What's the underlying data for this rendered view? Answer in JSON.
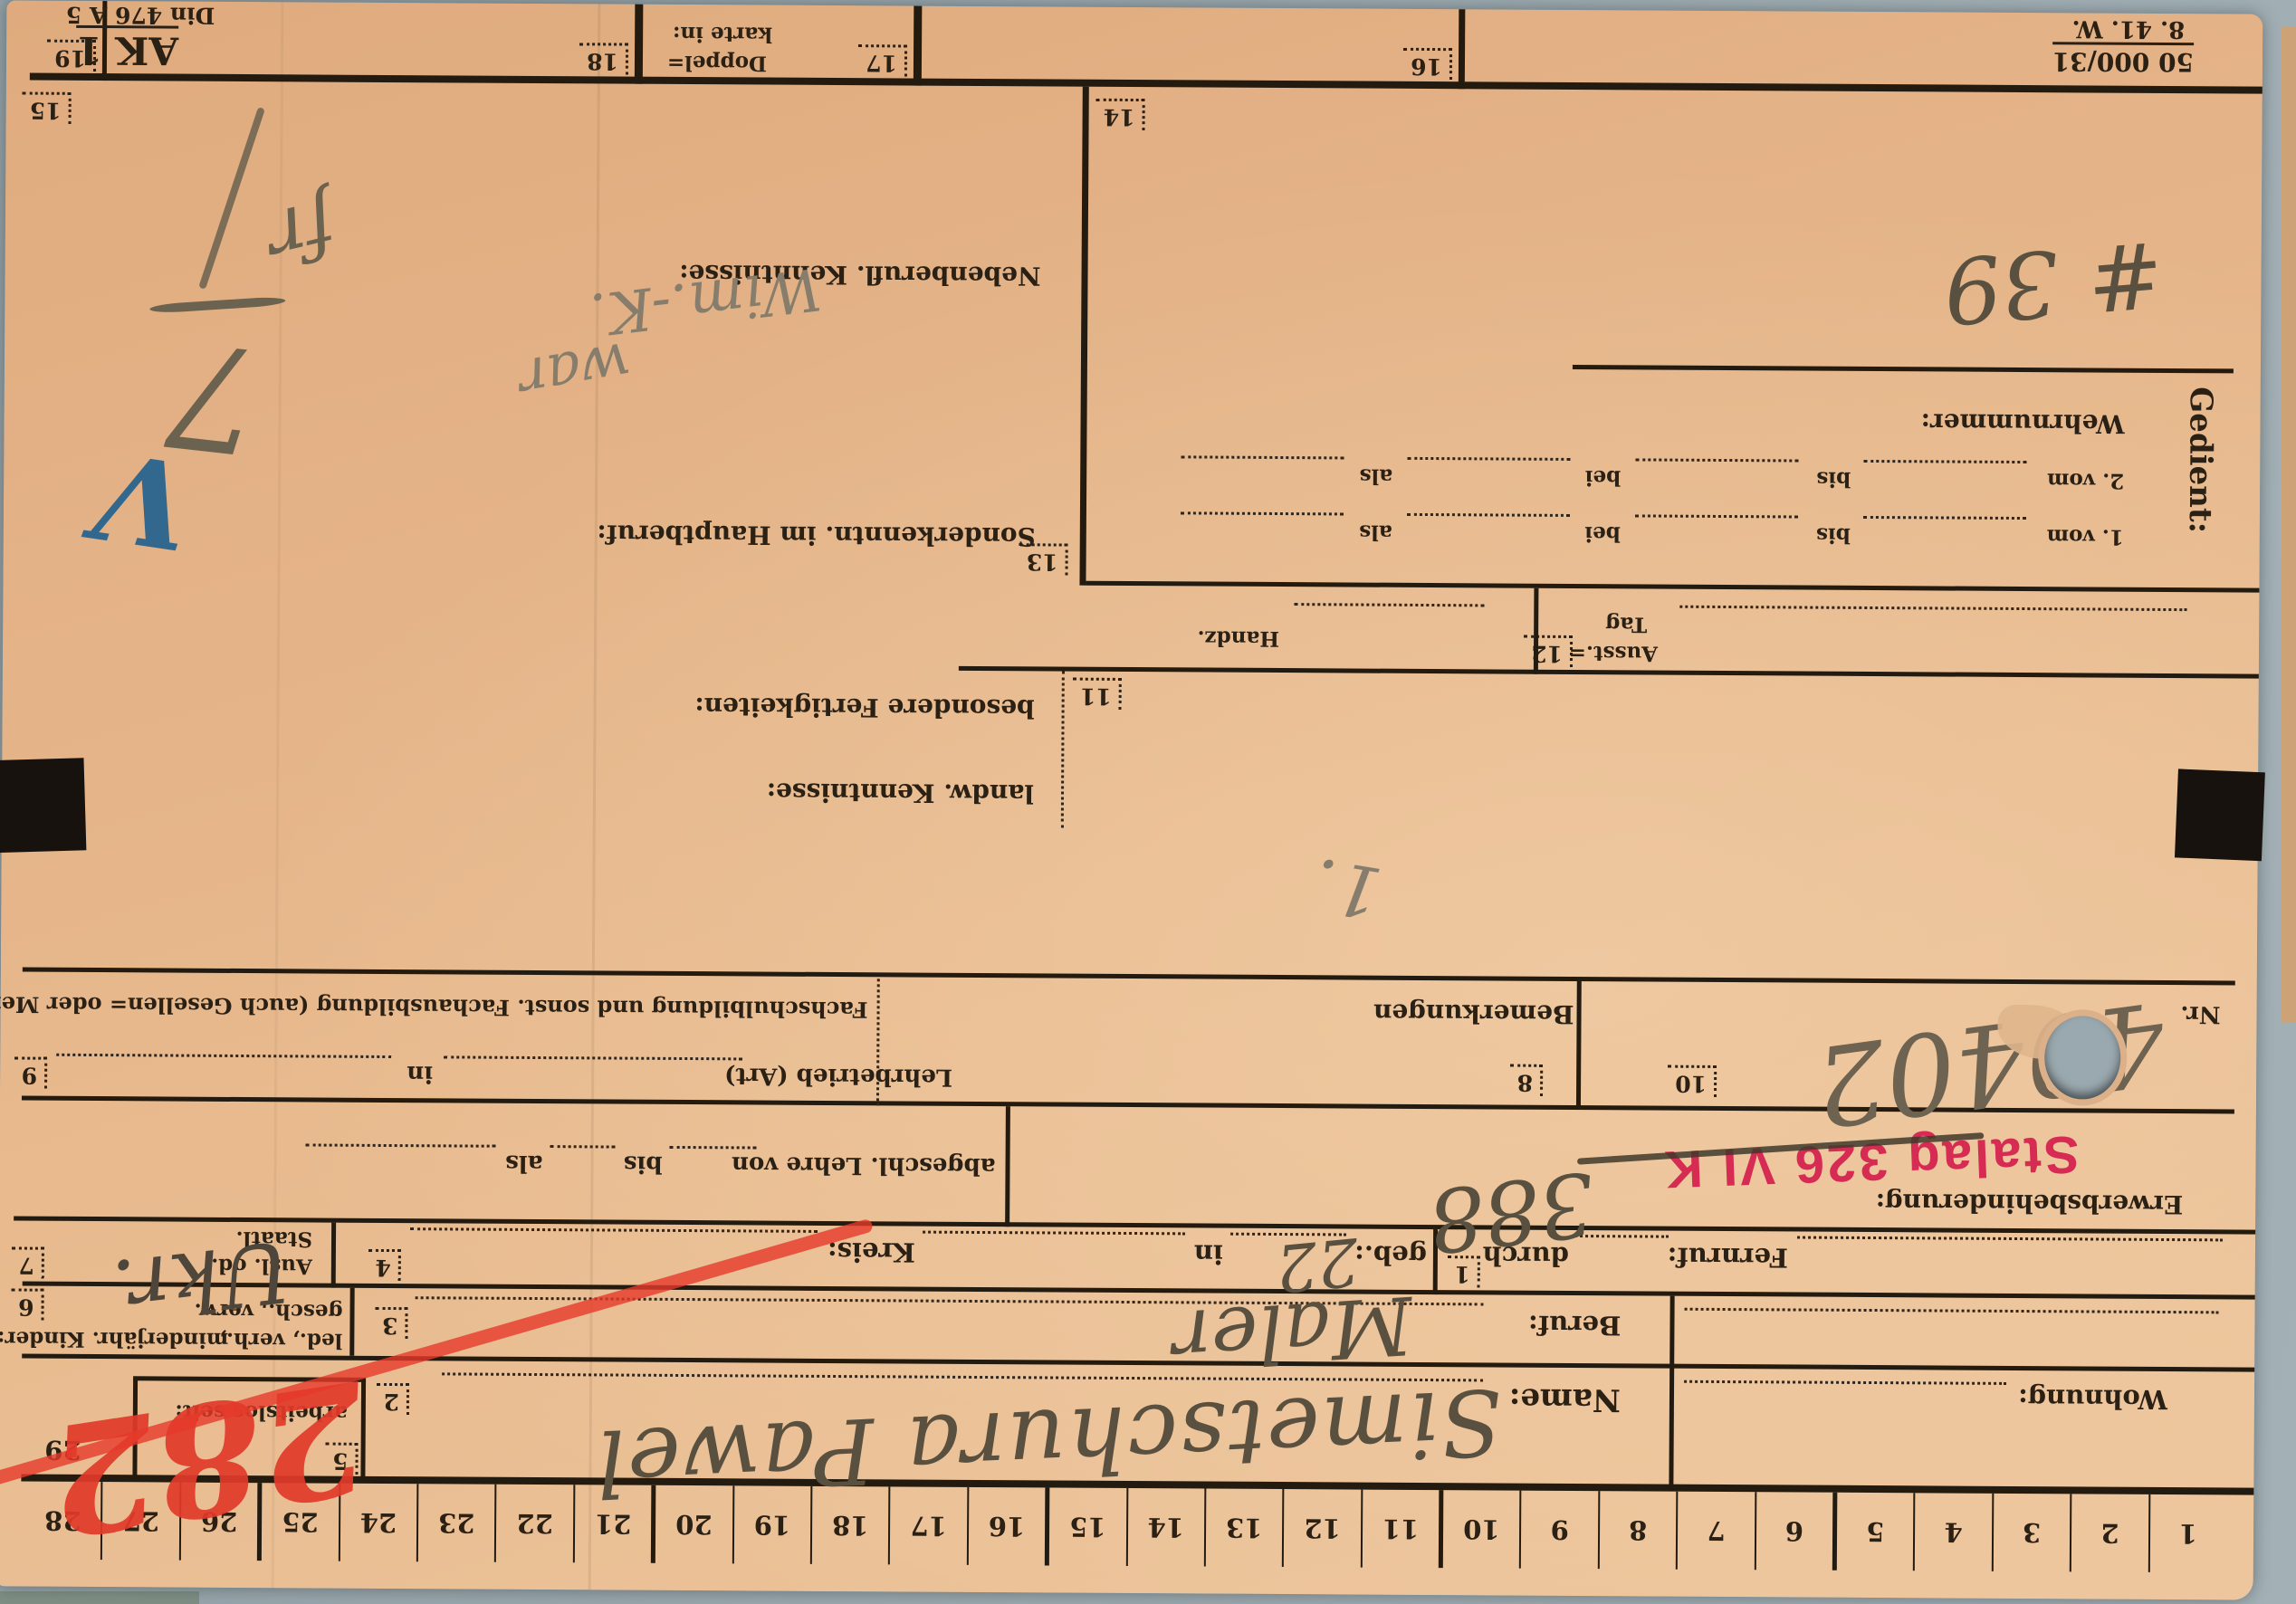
{
  "ruler": {
    "numbers": [
      "1",
      "2",
      "3",
      "4",
      "5",
      "6",
      "7",
      "8",
      "9",
      "10",
      "11",
      "12",
      "13",
      "14",
      "15",
      "16",
      "17",
      "18",
      "19",
      "20",
      "21",
      "22",
      "23",
      "24",
      "25",
      "26",
      "27",
      "28"
    ],
    "end_number": "29"
  },
  "fields": {
    "f1": "1",
    "f2": "2",
    "f3": "3",
    "f4": "4",
    "f5": "5",
    "f6": "6",
    "f7": "7",
    "f8": "8",
    "f9": "9",
    "f10": "10",
    "f11": "11",
    "f12": "12",
    "f13": "13",
    "f14": "14",
    "f15": "15",
    "f16": "16",
    "f17": "17",
    "f18": "18",
    "f19": "19"
  },
  "labels": {
    "wohnung": "Wohnung:",
    "name": "Name:",
    "beruf": "Beruf:",
    "arbeitslos": "arbeitslos seit:",
    "marital1": "led., verh.,",
    "marital2": "gesch., verw.",
    "kinder": "minderjähr. Kinder:",
    "fernruf": "Fernruf:",
    "durch": "durch",
    "geb": "geb.:",
    "in1": "in",
    "kreis": "Kreis:",
    "ausl1": "Ausl. od.",
    "ausl2": "Staatl.",
    "erwerb": "Erwerbsbehinderung:",
    "lehre": "abgeschl. Lehre von",
    "bis": "bis",
    "als": "als",
    "lehrbetrieb": "Lehrbetrieb (Art)",
    "in2": "in",
    "fachschule": "Fachschulbildung und sonst. Fachausbildung (auch Gesellen= oder Meisterprüfung):",
    "bemerkungen": "Bemerkungen",
    "nr": "Nr.",
    "landw": "landw. Kenntnisse:",
    "fertigkeiten": "besondere Fertigkeiten:",
    "ausst1": "Ausst.=",
    "ausst2": "Tag",
    "handz": "Handz.",
    "sonder": "Sonderkenntn. im Hauptberuf:",
    "nebenberuf": "Nebenberufl. Kenntnisse:"
  },
  "gedient": {
    "heading": "Gedient:",
    "row1_prefix": "1. vom",
    "row2_prefix": "2. vom",
    "bis": "bis",
    "bei": "bei",
    "als": "als",
    "wehrnummer": "Wehrnummer:"
  },
  "corner_prints": {
    "doppel1": "Doppel=",
    "doppel2": "karte in:",
    "print_run": "50 000/31",
    "print_date": "8. 41. W.",
    "form_code": "AK 1",
    "din": "Din 476 A 5"
  },
  "stamp": {
    "text": "Stalag 326 VI K",
    "color": "#d62b52"
  },
  "handwriting": {
    "name_entry": "Simetschura Pawel",
    "beruf_entry": "Maler",
    "geb_entry": "22",
    "nationality_entry": "Ukr.",
    "camp_number": "388",
    "red_number": "282",
    "nr_entry": "49402",
    "hash_number": "# 39",
    "note_line1": "war",
    "note_line2": "Wim.-K.",
    "corner_mark_top": "7",
    "corner_mark_bottom": "fr",
    "small_mark": "1.",
    "check_mark": "V"
  },
  "colors": {
    "paper": "#e8ba8e",
    "ink": "#2b2014",
    "stamp_red": "#d62b52",
    "crayon_red": "#e6392b",
    "pencil": "#59503f",
    "blue_mark": "#33688e",
    "background": "#9aa9af"
  }
}
